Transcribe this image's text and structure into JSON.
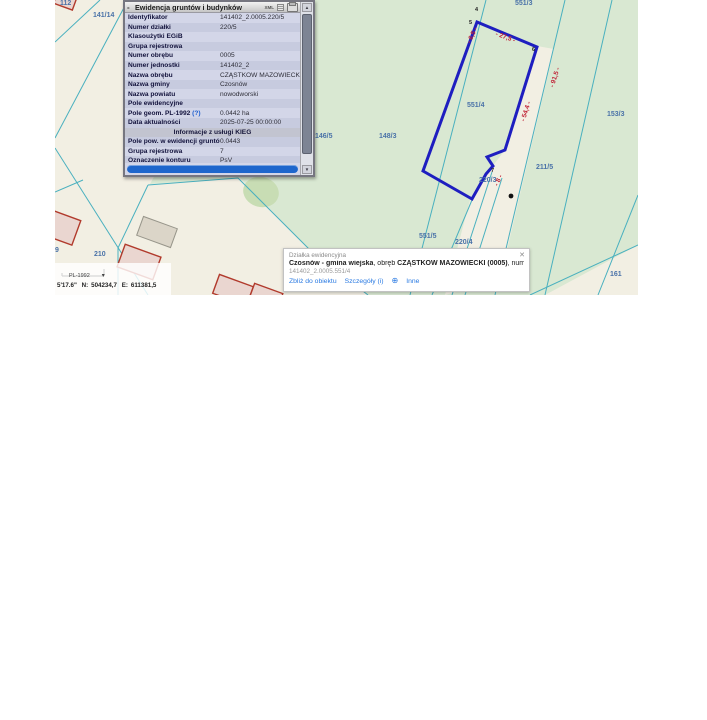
{
  "info_panel": {
    "title": "Ewidencja gruntów i budynków",
    "collapse_label": "-",
    "toolbar": {
      "xml_label": "XML"
    },
    "rows": [
      {
        "label": "Identyfikator",
        "value": "141402_2.0005.220/5"
      },
      {
        "label": "Numer działki",
        "value": "220/5"
      },
      {
        "label": "Klasoużytki EGiB",
        "value": ""
      },
      {
        "label": "Grupa rejestrowa",
        "value": ""
      },
      {
        "label": "Numer obrębu",
        "value": "0005"
      },
      {
        "label": "Numer jednostki",
        "value": "141402_2"
      },
      {
        "label": "Nazwa obrębu",
        "value": "CZĄSTKÓW MAZOWIECKI"
      },
      {
        "label": "Nazwa gminy",
        "value": "Czosnów"
      },
      {
        "label": "Nazwa powiatu",
        "value": "nowodworski"
      },
      {
        "label": "Pole ewidencyjne",
        "value": ""
      },
      {
        "label": "Pole geom. PL-1992",
        "help": "(?)",
        "value": "0.0442 ha"
      },
      {
        "label": "Data aktualności",
        "value": "2025-07-25 00:00:00"
      }
    ],
    "section_header": "Informacje z usługi KIEG",
    "kieg_rows": [
      {
        "label": "Pole pow. w ewidencji gruntów (ha)",
        "value": "0.0443"
      },
      {
        "label": "Grupa rejestrowa",
        "value": "7"
      },
      {
        "label": "Oznaczenie konturu",
        "value": "PsV"
      }
    ]
  },
  "feature_popup": {
    "type_label": "Działka ewidencyjna",
    "title_bold1": "Czosnów - gmina wiejska",
    "title_sep1": ", obręb ",
    "title_bold2": "CZĄSTKÓW MAZOWIECKI (0005)",
    "title_sep2": ", numer dz. ",
    "title_bold3": "551/4",
    "id_line": "141402_2.0005.551/4",
    "links": [
      "Zbliż do obiektu",
      "Szczegóły (i)",
      "Inne"
    ],
    "close_glyph": "✕",
    "plus_glyph": "⊕"
  },
  "status_bar": {
    "crs": "PL-1992",
    "chevron": "▾",
    "lon_fragment": "5'17.6\"",
    "n_label": "N:",
    "n_value": "504234,7",
    "e_label": "E:",
    "e_value": "611381,5"
  },
  "map": {
    "parcel_labels": [
      {
        "text": "112",
        "x": 5,
        "y": 0
      },
      {
        "text": "141/14",
        "x": 38,
        "y": 12
      },
      {
        "text": "551/3",
        "x": 460,
        "y": 0
      },
      {
        "text": "551/4",
        "x": 412,
        "y": 102
      },
      {
        "text": "146/5",
        "x": 260,
        "y": 133
      },
      {
        "text": "148/3",
        "x": 324,
        "y": 133
      },
      {
        "text": "153/3",
        "x": 552,
        "y": 111
      },
      {
        "text": "211/5",
        "x": 481,
        "y": 164
      },
      {
        "text": "220/3",
        "x": 424,
        "y": 177
      },
      {
        "text": "551/5",
        "x": 364,
        "y": 233
      },
      {
        "text": "220/4",
        "x": 400,
        "y": 239
      },
      {
        "text": "210",
        "x": 39,
        "y": 251
      },
      {
        "text": "9",
        "x": 0,
        "y": 247
      },
      {
        "text": "161",
        "x": 555,
        "y": 271
      }
    ],
    "point_labels": [
      {
        "text": "4",
        "x": 420,
        "y": 7
      },
      {
        "text": "5",
        "x": 414,
        "y": 20
      },
      {
        "text": "6",
        "x": 477,
        "y": 47
      },
      {
        "text": "7",
        "x": 436,
        "y": 168
      }
    ],
    "dimension_labels": [
      {
        "text": "- 6,5 -",
        "x": 409,
        "y": 32,
        "rot": -65
      },
      {
        "text": "- 27,5 -",
        "x": 440,
        "y": 34,
        "rot": 20
      },
      {
        "text": "- 54,4 -",
        "x": 461,
        "y": 108,
        "rot": -72
      },
      {
        "text": "- 91,5 -",
        "x": 490,
        "y": 74,
        "rot": -72
      },
      {
        "text": "- 8 -",
        "x": 438,
        "y": 177,
        "rot": -65
      }
    ],
    "colors": {
      "cream": "#f2efe3",
      "green": "#d9e8d2",
      "parcel_line": "#49b0bf",
      "highlight_parcel": "#1e1ec0",
      "label_blue": "#4a72a8",
      "dimension_red": "#c02438",
      "building_stroke": "#b13a2c",
      "building_fill": "#ead6d0",
      "accent_blue": "#1e66cc"
    }
  }
}
